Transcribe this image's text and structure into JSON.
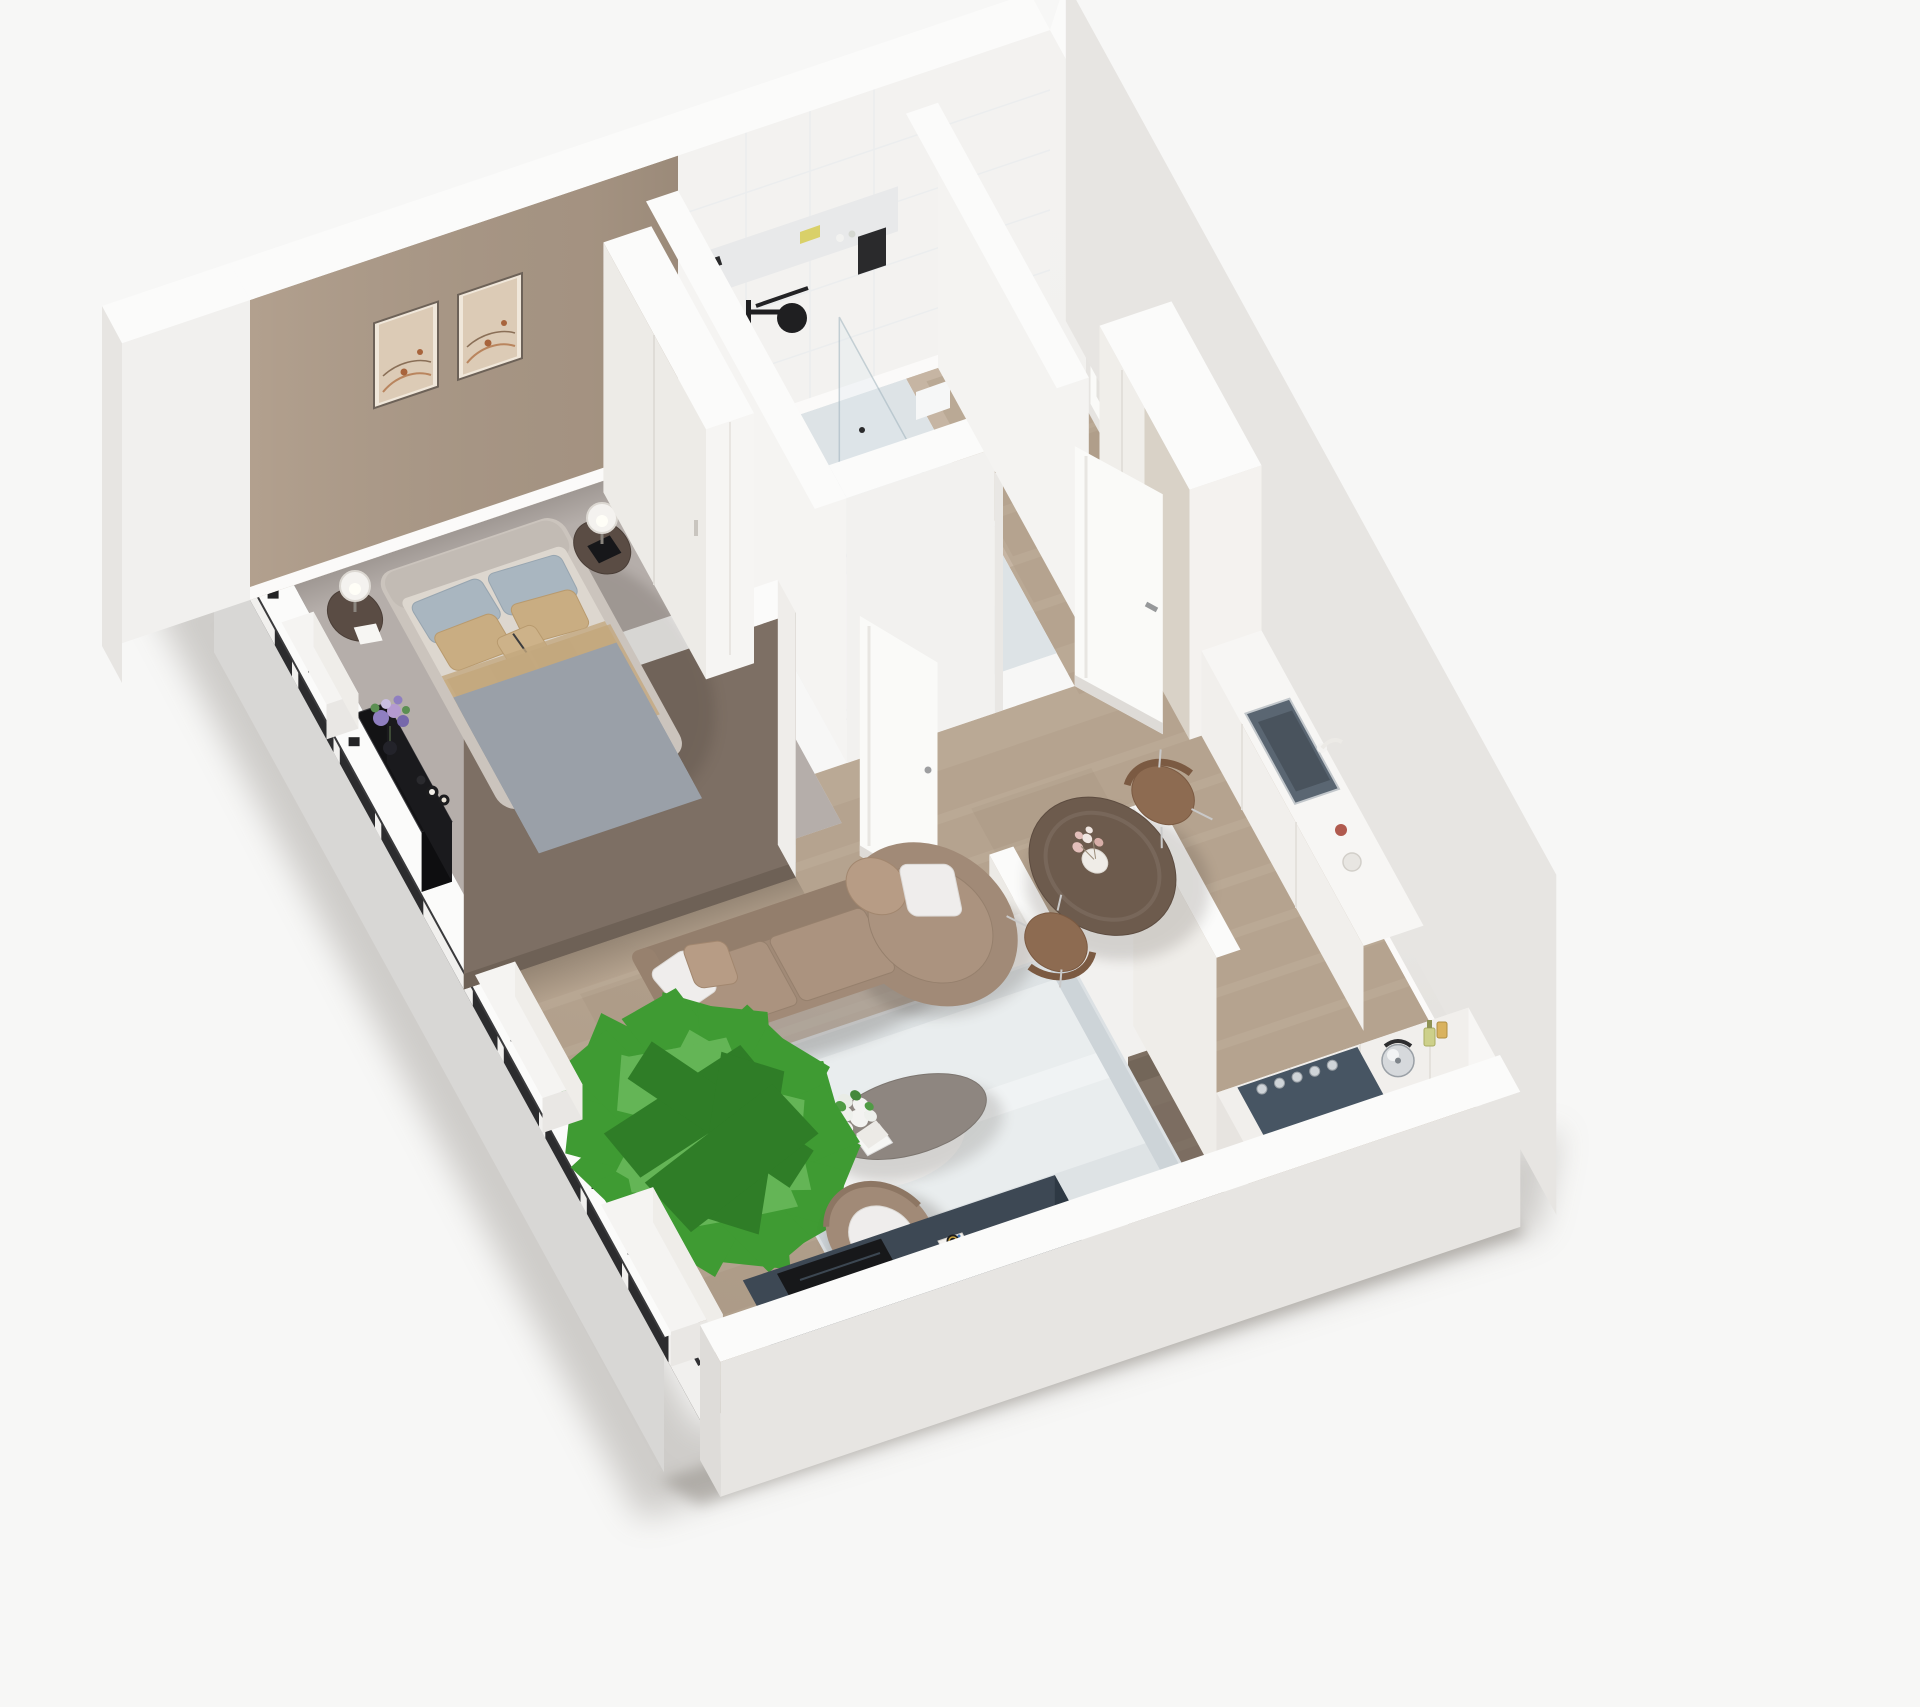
{
  "meta": {
    "description": "Cutaway axonometric 3D render of a one-bedroom apartment floor plan",
    "view": "isometric top-down"
  },
  "colors": {
    "background": "#f7f7f6",
    "ground_shadow": "#8d8882",
    "wall_white": "#f3f2f0",
    "wall_top": "#fbfbfa",
    "wall_outer": "#e7e5e2",
    "accent_wall": "#b2a08e",
    "partition_dark": "#7d6f64",
    "carpet": "#b5aeaa",
    "wood": "#c6b5a3",
    "wood_line": "#b19e8a",
    "wood_dark": "#8b7c6e",
    "tile_floor": "#f2f4f5",
    "window_frame": "#2c2c2e",
    "ledge": "#d8d7d5",
    "glass": "#dfe9ee",
    "sofa": "#a18a77",
    "sofa_cushion": "#ab937f",
    "pillow_white": "#efedec",
    "pillow_brown": "#b79c85",
    "rug": "#cdd4d8",
    "sheepskin": "#f2f2f1",
    "coffee_table": "#8e8680",
    "plant_green": "#3f9b33",
    "armchair": "#a18a77",
    "tv_console": "#3d4854",
    "tv_black": "#17181a",
    "dining_table": "#6d5b4d",
    "chair_leather": "#8d6b51",
    "bed_frame": "#cbc4bd",
    "mattress": "#ddd7cf",
    "duvet": "#d8c19c",
    "pillow_blue": "#a9b6c0",
    "pillow_tan": "#c9ad82",
    "throw_white": "#e9e7e3",
    "nightstand": "#5a4c44",
    "lamp_shade": "#f4f2ef",
    "wardrobe": "#f6f5f3",
    "cabinet_greige": "#d9d2c7",
    "counter_white": "#f7f6f4",
    "cooktop": "#475563",
    "sink_steel": "#5a6672",
    "chrome": "#c9cdd1",
    "flower_purple": "#8f7fc0",
    "flower_pink": "#e3bfba",
    "towel_yellow": "#d9d069",
    "art_beige": "#dccbb6",
    "door_white": "#fafaf8",
    "console_black": "#131315"
  },
  "scene": {
    "rooms": [
      {
        "name": "bedroom",
        "floor": "grey-carpet",
        "items": [
          "double-bed",
          "headboard",
          "blue-grey-pillows",
          "tan-pillows",
          "beige-duvet",
          "striped-throw",
          "nightstand-left",
          "nightstand-right",
          "table-lamp-left",
          "table-lamp-right",
          "wall-art-frame-1",
          "wall-art-frame-2",
          "white-wardrobe",
          "black-console-table",
          "purple-flower-vase",
          "candles"
        ]
      },
      {
        "name": "bathroom",
        "floor": "white-tile",
        "items": [
          "walk-in-shower",
          "black-shower-column",
          "glass-partition",
          "storage-bench",
          "vanity-with-basin",
          "wall-hung-toilet",
          "black-flush-plate",
          "towel-bar",
          "yellow-towel",
          "shelf-band"
        ]
      },
      {
        "name": "hallway",
        "floor": "oak-planks",
        "items": [
          "entry-door",
          "open-bathroom-door",
          "tall-cabinet-white",
          "tall-cabinet-greige"
        ]
      },
      {
        "name": "kitchen",
        "floor": "oak-planks",
        "items": [
          "sink-counter-run",
          "dark-undermount-sink",
          "faucet",
          "cooktop-counter-run",
          "slate-cooktop",
          "chrome-knobs",
          "kettle",
          "oil-bottles",
          "storage-nook"
        ]
      },
      {
        "name": "living-room",
        "floor": "oak-planks",
        "items": [
          "brown-sectional-sofa",
          "round-chaise",
          "white-pillows",
          "blue-grey-rug",
          "sheepskin-throw",
          "oval-coffee-table",
          "white-bouquet",
          "books",
          "potted-plant",
          "round-armchair",
          "tv-console",
          "flat-tv",
          "board-game",
          "round-dining-table",
          "dining-chair-ne",
          "dining-chair-sw",
          "dry-flower-vase",
          "open-bedroom-door"
        ]
      },
      {
        "name": "balcony-window-wall",
        "items": [
          "floor-to-ceiling-windows",
          "black-window-frames",
          "white-piers",
          "radiator-sill-boxes",
          "outer-ledge"
        ]
      }
    ]
  }
}
